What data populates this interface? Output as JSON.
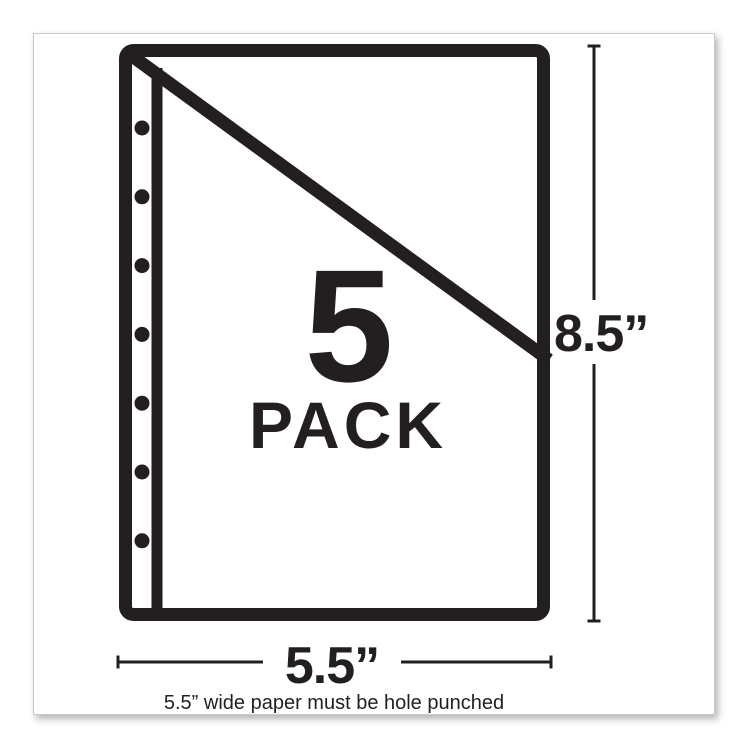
{
  "colors": {
    "ink": "#231f20",
    "card_border": "#c9c9c9",
    "card_background": "#ffffff",
    "page_background": "#ffffff"
  },
  "diagram": {
    "pack_quantity": "5",
    "pack_label": "PACK",
    "height_label": "8.5”",
    "width_label": "5.5”",
    "caption": "5.5” wide paper must be hole punched",
    "punch_hole_count": 7
  }
}
